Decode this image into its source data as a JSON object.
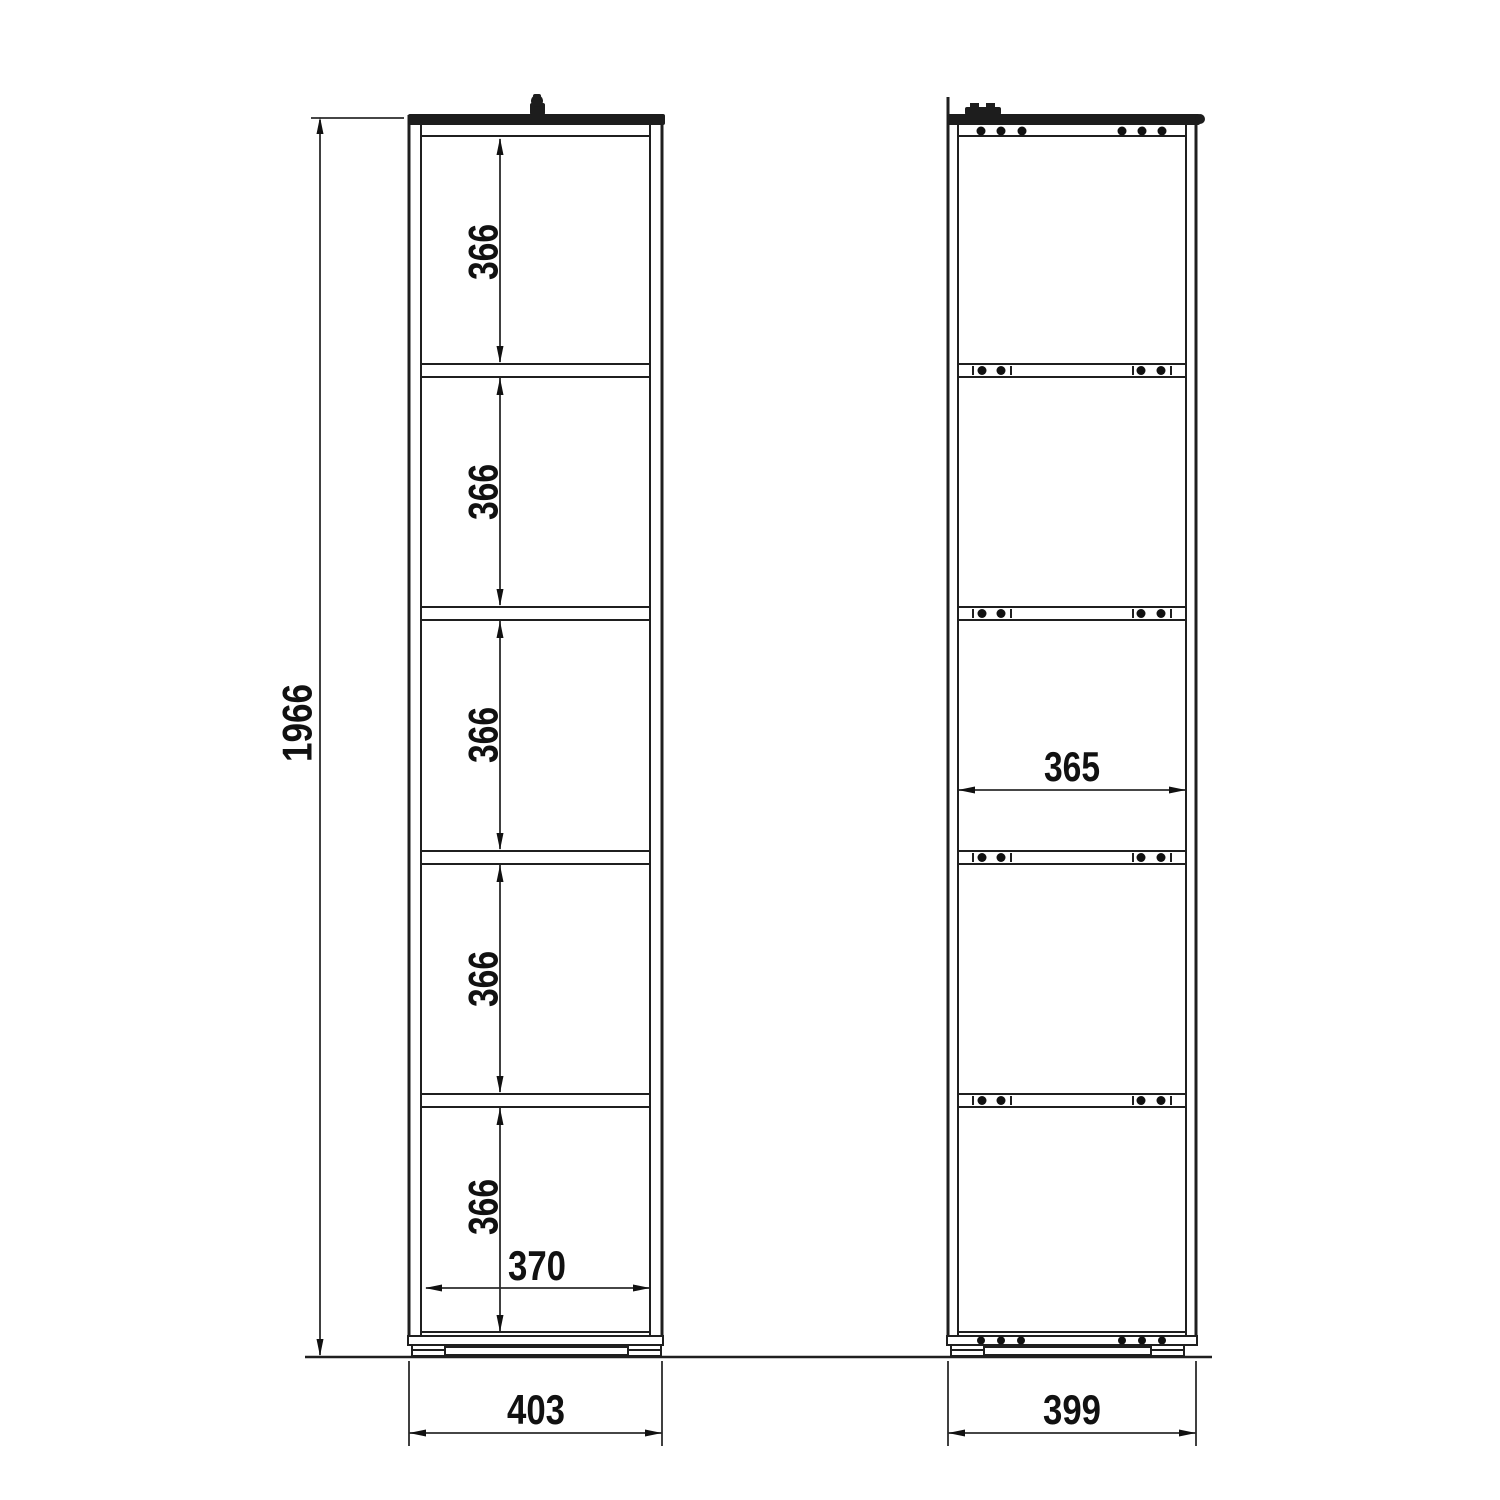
{
  "drawing": {
    "front_view": {
      "overall_height": "1966",
      "shelf_spacings": [
        "366",
        "366",
        "366",
        "366",
        "366"
      ],
      "inner_width": "370",
      "outer_width": "403"
    },
    "side_view": {
      "inner_depth": "365",
      "outer_depth": "399"
    },
    "colors": {
      "line": "#1f1f1f",
      "background": "#ffffff",
      "text": "#111111"
    }
  }
}
